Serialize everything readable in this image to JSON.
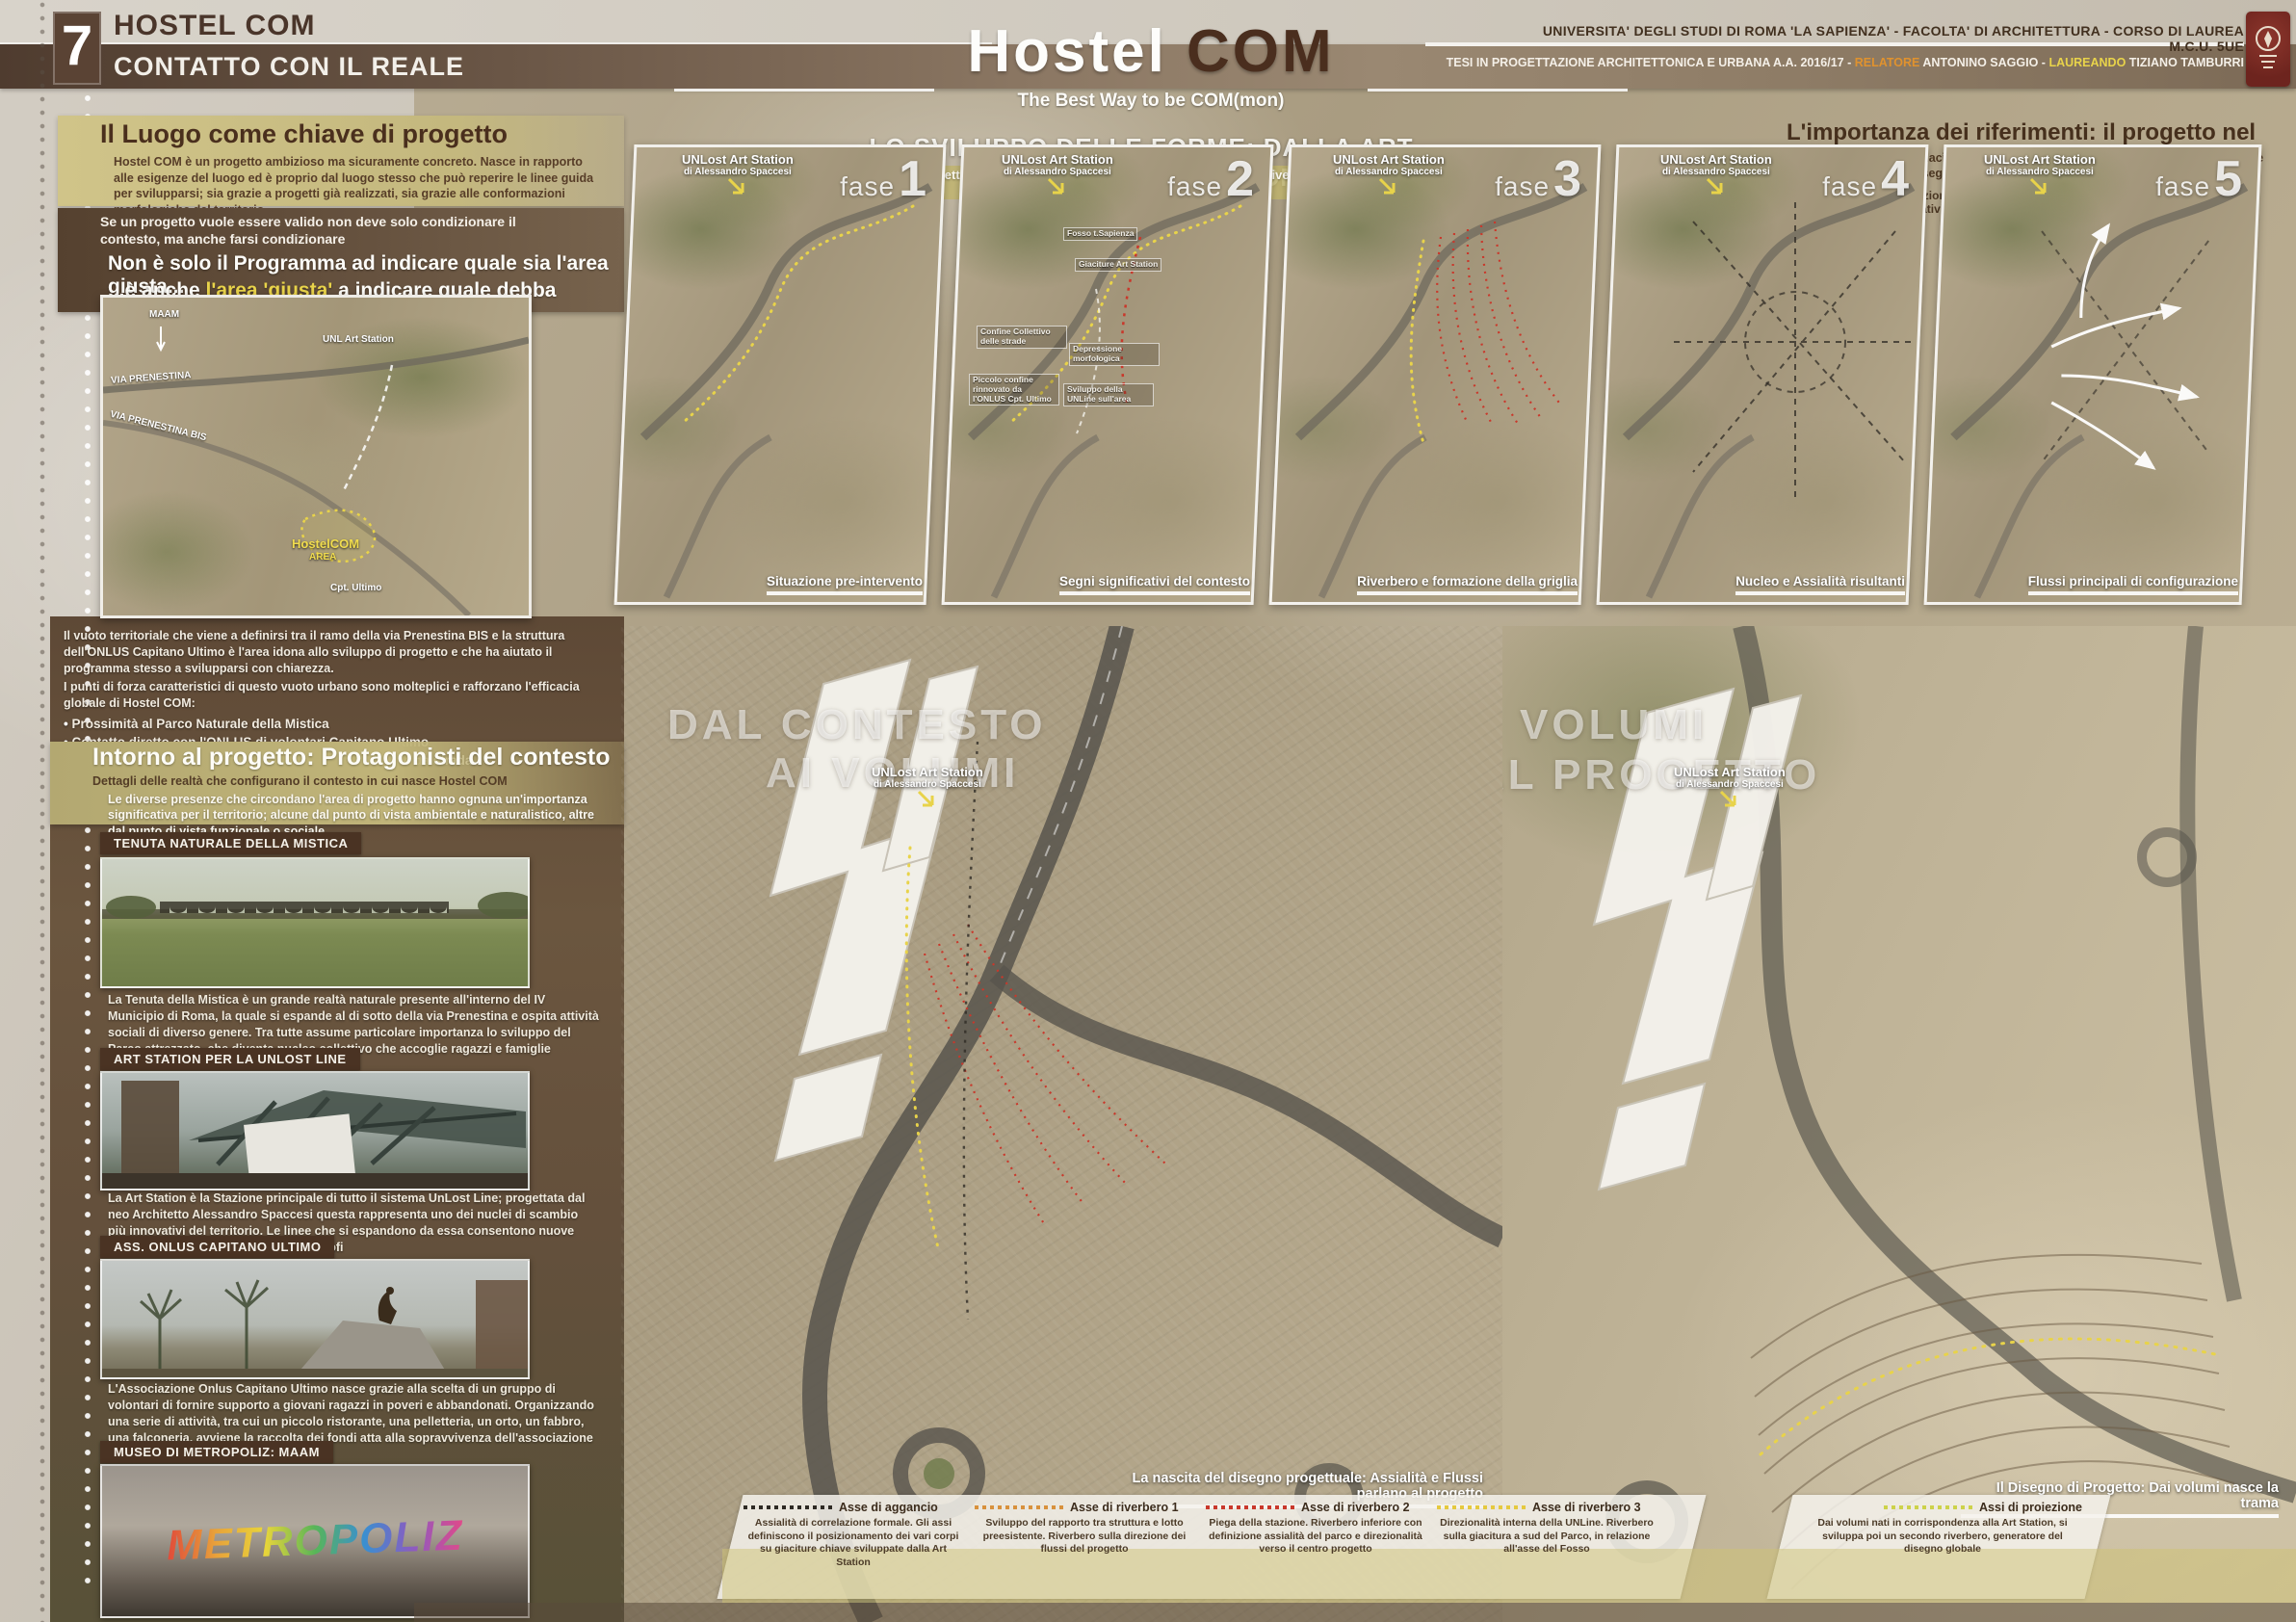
{
  "header": {
    "index": "7",
    "title": "HOSTEL COM",
    "subtitle": "CONTATTO CON IL REALE",
    "brand_white": "Hostel",
    "brand_brown": "COM",
    "tagline": "The Best Way to be COM(mon)",
    "university": "UNIVERSITA' DEGLI STUDI DI ROMA 'LA SAPIENZA' - FACOLTA' DI ARCHITETTURA - CORSO DI LAUREA M.C.U. 5UE",
    "thesis_prefix": "TESI IN PROGETTAZIONE ARCHITETTONICA E URBANA A.A. 2016/17",
    "sep": "-",
    "relatore_label": "RELATORE",
    "relatore_name": "ANTONINO SAGGIO",
    "laureando_label": "LAUREANDO",
    "laureando_name": "TIZIANO TAMBURRI"
  },
  "luogo": {
    "heading": "Il Luogo come chiave di progetto",
    "body": "Hostel COM è un progetto ambizioso ma sicuramente concreto. Nasce in rapporto alle esigenze del luogo ed è proprio dal luogo stesso che può reperire le linee guida per svilupparsi; sia grazie a progetti già realizzati, sia grazie alle conformazioni morfologiche del territorio"
  },
  "claim": {
    "intro": "Se un progetto vuole essere valido non deve solo condizionare il contesto, ma anche farsi condizionare",
    "line1": "Non è solo il Programma ad indicare quale sia l'area giusta...",
    "line2_pre": "...è anche ",
    "line2_accent": "l'area 'giusta'",
    "line2_post": " a indicare quale debba essere il programma"
  },
  "site_map": {
    "maam": "MAAM",
    "unl": "UNL Art Station",
    "prenestina": "VIA PRENESTINA",
    "prenestina_bis": "VIA PRENESTINA BIS",
    "hostel": "HostelCOM",
    "area": "AREA",
    "cpt": "Cpt. Ultimo"
  },
  "vuoto": {
    "p1": "Il vuoto territoriale che viene a definirsi tra il ramo della via Prenestina BIS e la struttura dell'ONLUS Capitano Ultimo è l'area idona allo sviluppo di progetto e che ha aiutato il programma stesso a svilupparsi con chiarezza.",
    "p2": "I punti di forza caratteristici di questo vuoto urbano sono molteplici e rafforzano l'efficacia globale di Hostel COM:",
    "bullets": [
      "Prossimità al Parco Naturale della Mistica",
      "Contatto diretto con l'ONLUS di volontari Capitano Ultimo",
      "Prospicenza alla Art Station",
      "Accessibilità semplice da strada",
      "Vicinanza al Museo di Metropoliz"
    ]
  },
  "intorno": {
    "heading": "Intorno al progetto: Protagonisti del contesto",
    "sub": "Dettagli delle realtà che configurano il contesto in cui nasce Hostel COM",
    "body": "Le diverse presenze che circondano l'area di progetto hanno ognuna un'importanza significativa per il territorio; alcune dal punto di vista ambientale e naturalistico, altre dal punto di vista funzionale o sociale"
  },
  "cards": [
    {
      "title": "TENUTA NATURALE DELLA MISTICA",
      "caption": "La Tenuta della Mistica è un grande realtà naturale presente all'interno del IV Municipio di Roma, la quale si espande al di sotto della via Prenestina e ospita attività sociali di diverso genere. Tra tutte assume particolare importanza lo sviluppo del Parco attrezzato, che diventa nucleo collettivo che accoglie ragazzi e famiglie"
    },
    {
      "title": "ART STATION PER LA UNLOST LINE",
      "caption": "La Art Station è la Stazione principale di tutto il sistema UnLost Line; progettata dal neo Architetto Alessandro Spaccesi questa rappresenta uno dei nuclei di scambio più innovativi del territorio. Le linee che si espandono da essa consentono nuove possibilità di sviluppo nei terreni limitrofi"
    },
    {
      "title": "ASS. ONLUS CAPITANO ULTIMO",
      "caption": "L'Associazione Onlus Capitano Ultimo nasce grazie alla scelta di un gruppo di volontari di fornire supporto a giovani ragazzi in poveri e abbandonati. Organizzando una serie di attività, tra cui un piccolo ristorante, una pelletteria, un orto, un fabbro, una falconeria, avviene la raccolta dei fondi atta alla sopravvivenza dell'associazione"
    },
    {
      "title": "MUSEO DI METROPOLIZ: MAAM",
      "caption": "",
      "graffiti": "METROPOLIZ"
    }
  ],
  "forme": {
    "heading": "LO SVILUPPO DELLE FORME: DALLA ART STATION A HOSTEL COM",
    "sub": "Il progetto di Alessandro Spaccesi; nodo della UnLost Line, diventa importante propulsore compositivo"
  },
  "riferimenti": {
    "heading": "L'importanza dei riferimenti: il progetto nel contesto",
    "body": "Basare il progetto su giaciture e assi di riferimento che ci offre il luogo è la chiave per definire forme e segni che nascono per quel territorio, e solo lì potrebbero farlo",
    "legend_dash": "Assi direzionali configurativi",
    "legend_arrow": "Flussi principali di giacitura"
  },
  "station": {
    "line1": "UNLost Art Station",
    "line2": "di Alessandro Spaccesi"
  },
  "fase_label": "fase",
  "phases": [
    {
      "num": "1",
      "caption": "Situazione pre-intervento"
    },
    {
      "num": "2",
      "caption": "Segni significativi del contesto"
    },
    {
      "num": "3",
      "caption": "Riverbero e formazione della griglia"
    },
    {
      "num": "4",
      "caption": "Nucleo e Assialità risultanti"
    },
    {
      "num": "5",
      "caption": "Flussi principali di configurazione"
    }
  ],
  "phase2_notes": [
    "Fosso t.Sapienza",
    "Giaciture Art Station",
    "Confine Collettivo delle strade",
    "Depressione morfologica",
    "Piccolo confine rinnovato da l'ONLUS Cpt. Ultimo",
    "Sviluppo della UNLine sull'area"
  ],
  "big_maps": {
    "left": {
      "ghost1": "DAL CONTESTO",
      "ghost2": "AI VOLUMI",
      "caption": "La nascita del disegno progettuale: Assialità e Flussi parlano al progetto"
    },
    "right": {
      "ghost1": "DAI VOLUMI",
      "ghost2": "AL PROGETTO",
      "caption": "Il Disegno di Progetto: Dai volumi nasce la trama"
    }
  },
  "legend": [
    {
      "title": "Asse di aggancio",
      "color": "#2e2a24",
      "desc": "Assialità di correlazione formale. Gli assi definiscono il posizionamento dei vari corpi su giaciture chiave sviluppate dalla Art Station"
    },
    {
      "title": "Asse di riverbero 1",
      "color": "#d8913c",
      "desc": "Sviluppo del rapporto tra struttura e lotto preesistente. Riverbero sulla direzione dei flussi del progetto"
    },
    {
      "title": "Asse di riverbero 2",
      "color": "#c9382b",
      "desc": "Piega della stazione. Riverbero inferiore con definizione assialità del parco e direzionalità verso il centro progetto"
    },
    {
      "title": "Asse di riverbero 3",
      "color": "#e5c93f",
      "desc": "Direzionalità interna della UNLine. Riverbero sulla giacitura a sud del Parco, in relazione all'asse del Fosso"
    },
    {
      "title": "Assi di proiezione",
      "color": "#cdd24a",
      "desc": "Dai volumi nati in corrispondenza alla Art Station, si sviluppa poi un secondo riverbero, generatore del disegno globale"
    }
  ],
  "colors": {
    "accent_yellow": "#e8d34a",
    "accent_orange": "#e0922e",
    "accent_red": "#c9382b",
    "olive_band": "#c4b87e",
    "brown_dark": "#4a3323",
    "band_brown": "#5e4a3a",
    "logo_red": "#7d2b26"
  }
}
